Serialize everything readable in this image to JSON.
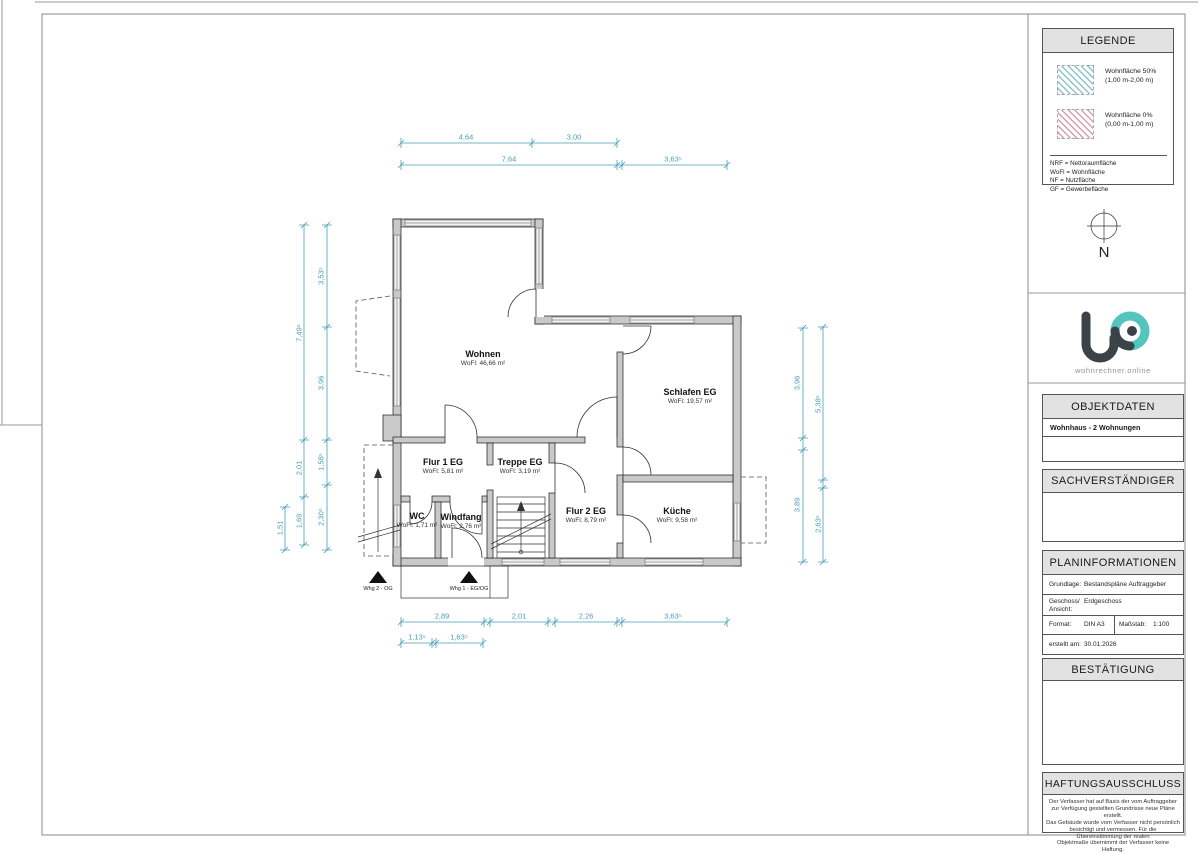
{
  "colors": {
    "dimension_teal": "#4a9db6",
    "logo_teal": "#54c4be",
    "logo_dark": "#3b4349",
    "hatch_50": "#8cc3cd",
    "hatch_0": "#d8a0aa",
    "wall_gray": "#c9c9c9",
    "header_gray": "#e2e2e2"
  },
  "legend": {
    "title": "LEGENDE",
    "items": [
      {
        "label": "Wohnfläche 50%",
        "range": "(1,00 m-2,00 m)"
      },
      {
        "label": "Wohnfläche 0%",
        "range": "(0,00 m-1,00 m)"
      }
    ],
    "abbreviations": [
      "NRF = Nettoraumfläche",
      "WoFl = Wohnfläche",
      "NF = Nutzfläche",
      "GF = Gewerbefläche"
    ]
  },
  "compass": {
    "label": "N"
  },
  "logo": {
    "text": "wohnrechner.online"
  },
  "sidebar": {
    "objektdaten": {
      "title": "OBJEKTDATEN",
      "value": "Wohnhaus - 2 Wohnungen"
    },
    "sachverstaendiger": {
      "title": "SACHVERSTÄNDIGER"
    },
    "planinfo": {
      "title": "PLANINFORMATIONEN",
      "grundlage_label": "Grundlage:",
      "grundlage_value": "Bestandspläne Auftraggeber",
      "geschoss_label_1": "Geschoss/",
      "geschoss_label_2": "Ansicht:",
      "geschoss_value": "Erdgeschoss",
      "format_label": "Format:",
      "format_value": "DIN A3",
      "massstab_label": "Maßstab:",
      "massstab_value": "1:100",
      "erstellt_label": "erstellt am:",
      "erstellt_value": "30.01.2026"
    },
    "bestaetigung": {
      "title": "BESTÄTIGUNG"
    },
    "haftung": {
      "title": "HAFTUNGSAUSSCHLUSS",
      "text": "Der Verfasser hat auf Basis der vom Auftraggeber\nzur Verfügung gestellten Grundrisse neue Pläne erstellt.\nDas Gebäude wurde vom Verfasser nicht persönlich\nbesichtigt und vermessen. Für die Übereinstimmung der realen\nObjektmaße übernimmt der Verfasser keine Haftung."
    }
  },
  "plan": {
    "floor": "Erdgeschoss",
    "rooms": [
      {
        "name": "Wohnen",
        "area": "WoFl: 46,66 m²",
        "x": 483,
        "y": 358
      },
      {
        "name": "Schlafen EG",
        "area": "WoFl: 19,57 m²",
        "x": 690,
        "y": 396
      },
      {
        "name": "Flur 1 EG",
        "area": "WoFl: 5,81 m²",
        "x": 443,
        "y": 466
      },
      {
        "name": "Treppe EG",
        "area": "WoFl: 3,19 m²",
        "x": 520,
        "y": 466
      },
      {
        "name": "WC",
        "area": "WoFl: 1,71 m²",
        "x": 417,
        "y": 520
      },
      {
        "name": "Windfang",
        "area": "WoFl: 2,76 m²",
        "x": 461,
        "y": 521
      },
      {
        "name": "Flur 2 EG",
        "area": "WoFl: 8,79 m²",
        "x": 586,
        "y": 515
      },
      {
        "name": "Küche",
        "area": "WoFl: 9,58 m²",
        "x": 677,
        "y": 515
      }
    ],
    "dimensions": [
      {
        "text": "4,64",
        "x": 466,
        "y": 137,
        "rot": 0
      },
      {
        "text": "3,00",
        "x": 574,
        "y": 137,
        "rot": 0
      },
      {
        "text": "7,64",
        "x": 509,
        "y": 159,
        "rot": 0
      },
      {
        "text": "3,63⁵",
        "x": 673,
        "y": 159,
        "rot": 0
      },
      {
        "text": "3,53⁵",
        "x": 321,
        "y": 276,
        "rot": -90
      },
      {
        "text": "7,49⁵",
        "x": 299,
        "y": 333,
        "rot": -90
      },
      {
        "text": "3,96",
        "x": 321,
        "y": 383,
        "rot": -90
      },
      {
        "text": "2,01",
        "x": 299,
        "y": 468,
        "rot": -90
      },
      {
        "text": "1,58⁵",
        "x": 321,
        "y": 462,
        "rot": -90
      },
      {
        "text": "1,51",
        "x": 280,
        "y": 528,
        "rot": -90
      },
      {
        "text": "1,69",
        "x": 299,
        "y": 521,
        "rot": -90
      },
      {
        "text": "2,30⁵",
        "x": 321,
        "y": 517,
        "rot": -90
      },
      {
        "text": "3,96",
        "x": 797,
        "y": 383,
        "rot": -90
      },
      {
        "text": "5,38⁵",
        "x": 818,
        "y": 404,
        "rot": -90
      },
      {
        "text": "3,89",
        "x": 797,
        "y": 505,
        "rot": -90
      },
      {
        "text": "2,63⁵",
        "x": 818,
        "y": 524,
        "rot": -90
      },
      {
        "text": "2,89",
        "x": 442,
        "y": 616,
        "rot": 0
      },
      {
        "text": "2,01",
        "x": 519,
        "y": 616,
        "rot": 0
      },
      {
        "text": "2,26",
        "x": 586,
        "y": 616,
        "rot": 0
      },
      {
        "text": "3,63⁵",
        "x": 673,
        "y": 616,
        "rot": 0
      },
      {
        "text": "1,13⁵",
        "x": 417,
        "y": 637,
        "rot": 0
      },
      {
        "text": "1,63⁵",
        "x": 459,
        "y": 637,
        "rot": 0
      }
    ],
    "entrances": [
      {
        "label": "Whg 2 - OG",
        "x": 378,
        "y": 589
      },
      {
        "label": "Whg 1 - EG/OG",
        "x": 469,
        "y": 589
      }
    ]
  }
}
